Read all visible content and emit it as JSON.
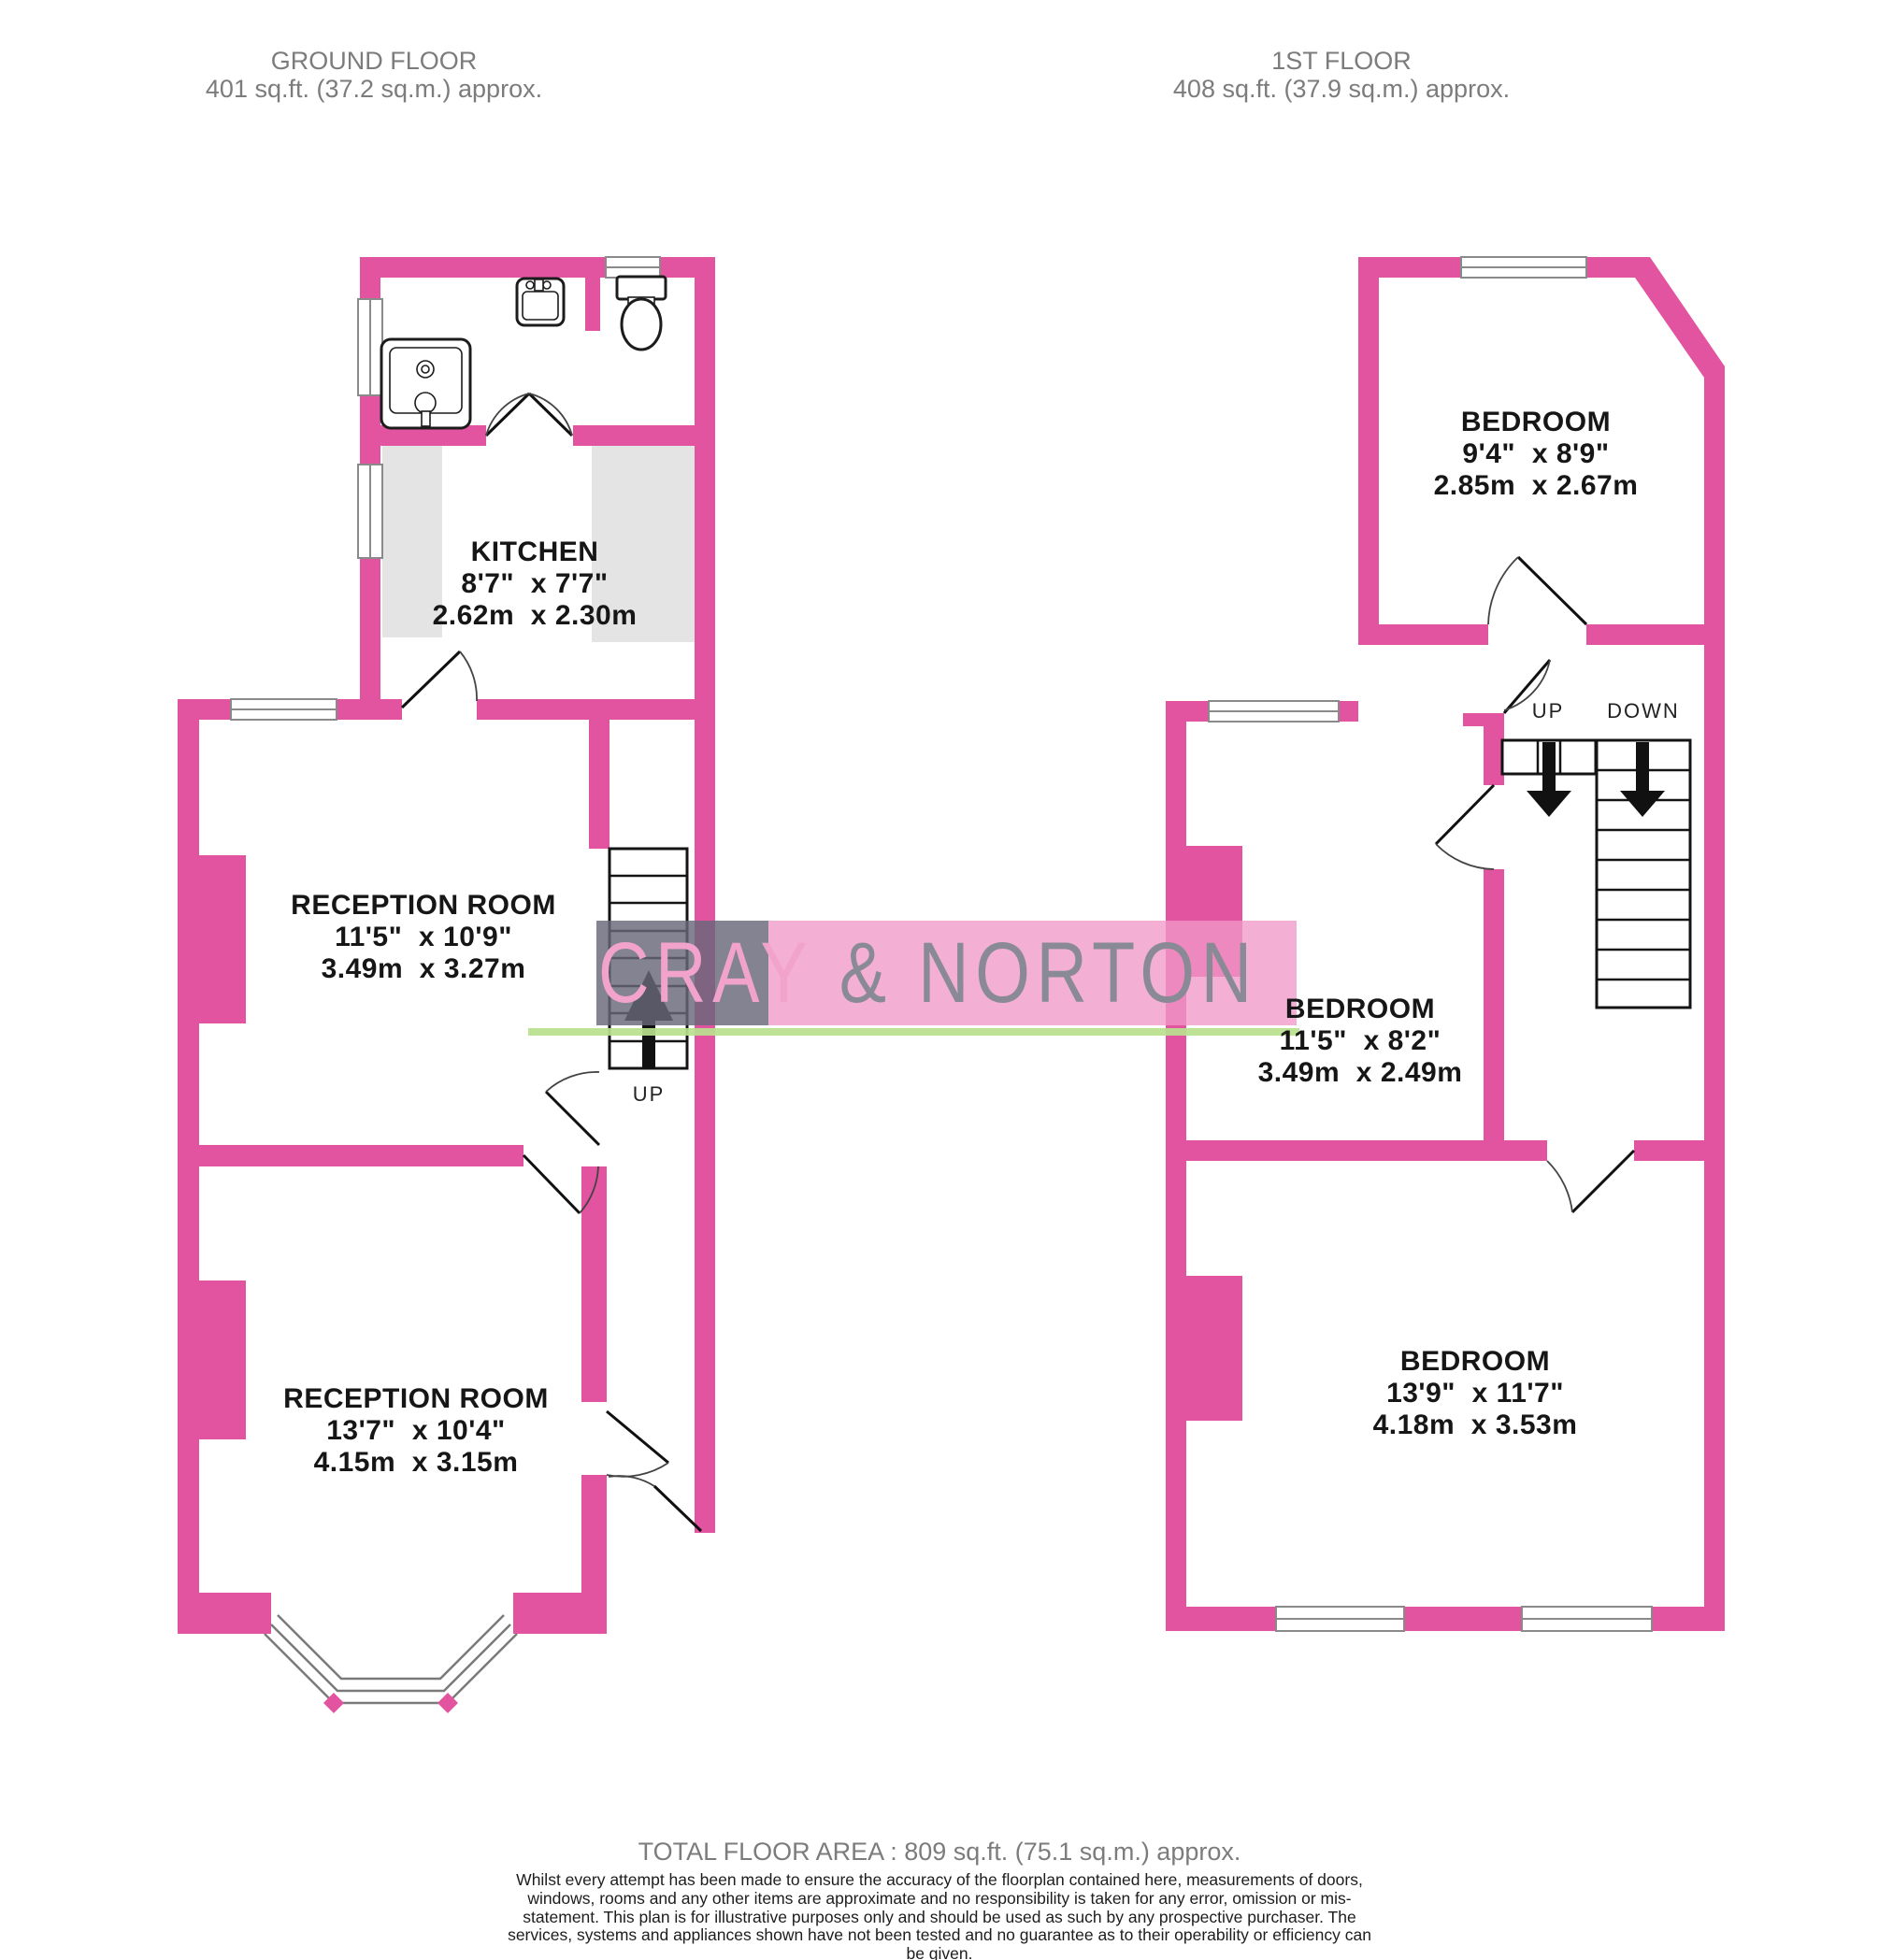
{
  "header": {
    "ground_floor": {
      "title": "GROUND FLOOR",
      "area": "401 sq.ft. (37.2 sq.m.) approx."
    },
    "first_floor": {
      "title": "1ST FLOOR",
      "area": "408 sq.ft. (37.9 sq.m.) approx."
    }
  },
  "ground_floor": {
    "rooms": [
      {
        "name": "KITCHEN",
        "imperial": "8'7\"  x 7'7\"",
        "metric": "2.62m  x 2.30m"
      },
      {
        "name": "RECEPTION ROOM",
        "imperial": "11'5\"  x 10'9\"",
        "metric": "3.49m  x 3.27m"
      },
      {
        "name": "RECEPTION ROOM",
        "imperial": "13'7\"  x 10'4\"",
        "metric": "4.15m  x 3.15m"
      }
    ],
    "stairs_label": "UP"
  },
  "first_floor": {
    "rooms": [
      {
        "name": "BEDROOM",
        "imperial": "9'4\"  x 8'9\"",
        "metric": "2.85m  x 2.67m"
      },
      {
        "name": "BEDROOM",
        "imperial": "11'5\"  x 8'2\"",
        "metric": "3.49m  x 2.49m"
      },
      {
        "name": "BEDROOM",
        "imperial": "13'9\"  x 11'7\"",
        "metric": "4.18m  x 3.53m"
      }
    ],
    "stairs_labels": {
      "up": "UP",
      "down": "DOWN"
    }
  },
  "watermark": {
    "left": "CRAY",
    "right": "& NORTON"
  },
  "footer": {
    "total": "TOTAL FLOOR AREA : 809 sq.ft. (75.1 sq.m.) approx.",
    "disclaimer": "Whilst every attempt has been made to ensure the accuracy of the floorplan contained here, measurements of doors, windows, rooms and any other items are approximate and no responsibility is taken for any error, omission or mis-statement. This plan is for illustrative purposes only and should be used as such by any prospective purchaser. The services, systems and appliances shown have not been tested and no guarantee as to their operability or efficiency can be given.",
    "credit": "Made with Metropix ©2025"
  },
  "colors": {
    "wall": "#E2549F",
    "watermark_gray": "#8A8A96",
    "watermark_pink": "#F2A3CB",
    "green_line": "#B9E18E",
    "label_gray": "#7C7C7C"
  }
}
